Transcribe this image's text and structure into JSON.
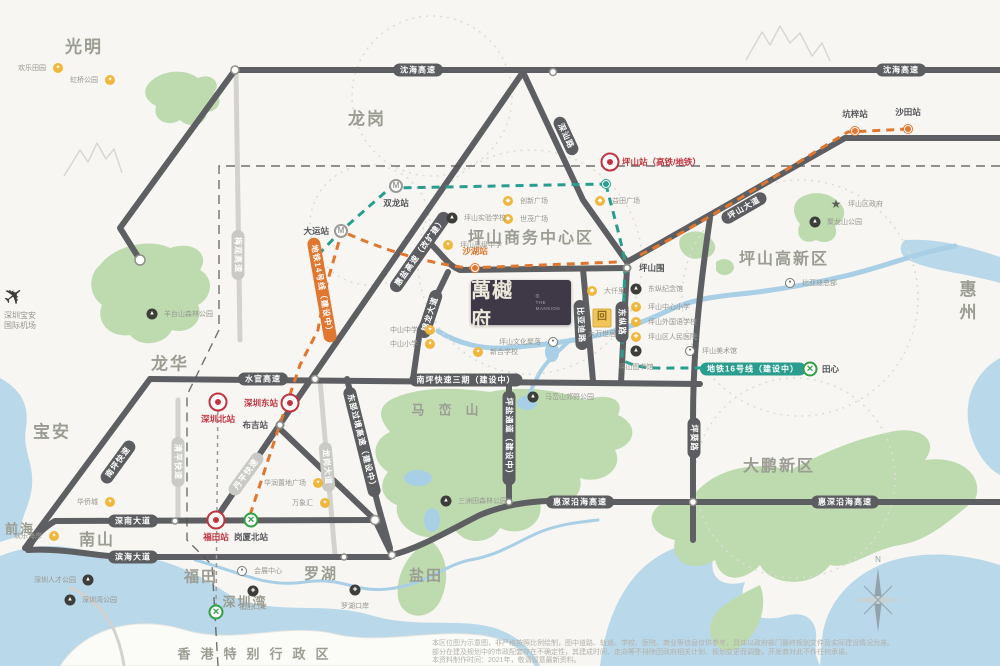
{
  "project": {
    "name": "萬樾府",
    "registered": "®",
    "subtitle_en": "THE MANSION"
  },
  "airport": {
    "line1": "深圳宝安",
    "line2": "国际机场"
  },
  "compass": {
    "north": "N"
  },
  "regions": [
    {
      "text": "光明",
      "x": 84,
      "y": 45,
      "size": 17
    },
    {
      "text": "龙岗",
      "x": 367,
      "y": 117,
      "size": 17
    },
    {
      "text": "龙华",
      "x": 170,
      "y": 362,
      "size": 17
    },
    {
      "text": "宝安",
      "x": 52,
      "y": 430,
      "size": 17
    },
    {
      "text": "南山",
      "x": 97,
      "y": 538,
      "size": 16
    },
    {
      "text": "前海",
      "x": 20,
      "y": 528,
      "size": 13
    },
    {
      "text": "福田",
      "x": 201,
      "y": 576,
      "size": 15
    },
    {
      "text": "罗湖",
      "x": 321,
      "y": 573,
      "size": 15
    },
    {
      "text": "盐田",
      "x": 426,
      "y": 575,
      "size": 15
    },
    {
      "text": "深圳湾",
      "x": 245,
      "y": 601,
      "size": 13
    },
    {
      "text": "惠州",
      "x": 966,
      "y": 303,
      "size": 17,
      "vertical": true
    },
    {
      "text": "大鹏新区",
      "x": 779,
      "y": 464,
      "size": 16
    },
    {
      "text": "坪山商务中心区",
      "x": 531,
      "y": 236,
      "size": 16
    },
    {
      "text": "坪山高新区",
      "x": 784,
      "y": 257,
      "size": 16
    },
    {
      "text": "马峦山",
      "x": 452,
      "y": 409,
      "size": 13,
      "spaced": true
    },
    {
      "text": "香港特别行政区",
      "x": 258,
      "y": 653,
      "size": 13,
      "spaced2": true
    }
  ],
  "pills": [
    {
      "text": "沈海高速",
      "x": 418,
      "y": 70,
      "rot": 0,
      "style": "dark"
    },
    {
      "text": "沈海高速",
      "x": 901,
      "y": 70,
      "rot": 0,
      "style": "dark"
    },
    {
      "text": "深汕路",
      "x": 566,
      "y": 136,
      "rot": 65,
      "style": "dark"
    },
    {
      "text": "坪山大道",
      "x": 744,
      "y": 208,
      "rot": -30,
      "style": "dark"
    },
    {
      "text": "惠盐高速（改扩建）",
      "x": 420,
      "y": 252,
      "rot": -55,
      "style": "dark"
    },
    {
      "text": "水官高速",
      "x": 263,
      "y": 379,
      "rot": 0,
      "style": "dark"
    },
    {
      "text": "南坪快速三期（建设中）",
      "x": 466,
      "y": 380,
      "rot": 0,
      "style": "dark"
    },
    {
      "text": "南坪快速",
      "x": 118,
      "y": 462,
      "rot": -54,
      "style": "dark"
    },
    {
      "text": "东部过境高速（建设中）",
      "x": 362,
      "y": 442,
      "rot": 76,
      "style": "dark"
    },
    {
      "text": "坪盐通道（建设中）",
      "x": 509,
      "y": 438,
      "rot": 90,
      "style": "dark"
    },
    {
      "text": "锦龙大道",
      "x": 430,
      "y": 314,
      "rot": -72,
      "style": "dark"
    },
    {
      "text": "比亚迪路",
      "x": 581,
      "y": 325,
      "rot": 87,
      "style": "dark"
    },
    {
      "text": "东纵路",
      "x": 622,
      "y": 322,
      "rot": 90,
      "style": "dark"
    },
    {
      "text": "坪葵路",
      "x": 694,
      "y": 438,
      "rot": 90,
      "style": "dark"
    },
    {
      "text": "深南大道",
      "x": 133,
      "y": 521,
      "rot": 0,
      "style": "dark"
    },
    {
      "text": "滨海大道",
      "x": 133,
      "y": 557,
      "rot": 0,
      "style": "dark"
    },
    {
      "text": "惠深沿海高速",
      "x": 580,
      "y": 502,
      "rot": 0,
      "style": "dark"
    },
    {
      "text": "惠深沿海高速",
      "x": 845,
      "y": 502,
      "rot": 0,
      "style": "dark"
    },
    {
      "text": "梅观高速",
      "x": 238,
      "y": 255,
      "rot": 90,
      "style": "light"
    },
    {
      "text": "清平快速",
      "x": 178,
      "y": 462,
      "rot": 90,
      "style": "light"
    },
    {
      "text": "丹平快速",
      "x": 246,
      "y": 474,
      "rot": -54,
      "style": "light"
    },
    {
      "text": "龙岗大道",
      "x": 327,
      "y": 467,
      "rot": 85,
      "style": "light"
    },
    {
      "text": "地铁14号线（建设中）",
      "x": 322,
      "y": 290,
      "rot": 80,
      "style": "orange"
    },
    {
      "text": "地铁16号线（建设中）",
      "x": 753,
      "y": 369,
      "rot": 0,
      "style": "teal"
    }
  ],
  "stations": [
    {
      "label": "坪山站（高铁/地铁）",
      "x": 610,
      "y": 162,
      "type": "hsr",
      "side": "r",
      "color": "red"
    },
    {
      "label": "深圳北站",
      "x": 218,
      "y": 402,
      "type": "hsr",
      "side": "b",
      "color": "red"
    },
    {
      "label": "深圳东站",
      "x": 290,
      "y": 403,
      "type": "hsr",
      "side": "l",
      "color": "red"
    },
    {
      "label": "福田站",
      "x": 216,
      "y": 520,
      "type": "hsr",
      "side": "b",
      "color": "red"
    },
    {
      "label": "双龙站",
      "x": 396,
      "y": 186,
      "type": "mgray",
      "side": "b"
    },
    {
      "label": "大运站",
      "x": 341,
      "y": 231,
      "type": "mgray",
      "side": "l"
    },
    {
      "label": "布吉站",
      "x": 280,
      "y": 425,
      "type": "dotc",
      "side": "l"
    },
    {
      "label": "坪山围",
      "x": 627,
      "y": 268,
      "type": "dotc",
      "side": "r"
    },
    {
      "label": "沙湖站",
      "x": 475,
      "y": 268,
      "type": "dotor",
      "side": "t",
      "color": "or"
    },
    {
      "label": "坑梓站",
      "x": 855,
      "y": 131,
      "type": "dotor",
      "side": "t"
    },
    {
      "label": "沙田站",
      "x": 908,
      "y": 129,
      "type": "dotor",
      "side": "t"
    },
    {
      "label": "",
      "x": 606,
      "y": 184,
      "type": "dottl",
      "side": "r"
    },
    {
      "label": "岗厦北站",
      "x": 251,
      "y": 520,
      "type": "mgreen",
      "side": "b"
    },
    {
      "label": "田心",
      "x": 810,
      "y": 369,
      "type": "mgreen",
      "side": "r"
    },
    {
      "label": "",
      "x": 216,
      "y": 612,
      "type": "mgreen",
      "side": "r"
    }
  ],
  "metro_glyph": {
    "gray": "M",
    "green": "✕"
  },
  "amenities": [
    {
      "name": "创新广场",
      "x": 508,
      "y": 201,
      "icon": "mall",
      "side": "r"
    },
    {
      "name": "世茂广场",
      "x": 508,
      "y": 219,
      "icon": "mall",
      "side": "r"
    },
    {
      "name": "益田广场",
      "x": 600,
      "y": 201,
      "icon": "mall",
      "side": "r"
    },
    {
      "name": "坪山实验学校",
      "x": 452,
      "y": 218,
      "icon": "park",
      "side": "r"
    },
    {
      "name": "坪山高级中学",
      "x": 448,
      "y": 245,
      "icon": "school",
      "side": "r"
    },
    {
      "name": "中山中学",
      "x": 430,
      "y": 330,
      "icon": "school",
      "side": "l"
    },
    {
      "name": "中山小学",
      "x": 430,
      "y": 344,
      "icon": "school",
      "side": "l"
    },
    {
      "name": "新合学校",
      "x": 478,
      "y": 352,
      "icon": "school",
      "side": "r"
    },
    {
      "name": "坪山文化聚落",
      "x": 553,
      "y": 342,
      "icon": "museum",
      "side": "l"
    },
    {
      "name": "大仟里",
      "x": 592,
      "y": 291,
      "icon": "mall",
      "side": "r"
    },
    {
      "name": "大万世居",
      "x": 602,
      "y": 318,
      "icon": "heritage",
      "side": "b"
    },
    {
      "name": "东纵纪念馆",
      "x": 636,
      "y": 289,
      "icon": "park",
      "side": "r"
    },
    {
      "name": "坪山中心小学",
      "x": 636,
      "y": 307,
      "icon": "school",
      "side": "r"
    },
    {
      "name": "坪山外国语学校",
      "x": 636,
      "y": 322,
      "icon": "school",
      "side": "r"
    },
    {
      "name": "坪山区人民医院",
      "x": 636,
      "y": 337,
      "icon": "hospital",
      "side": "r"
    },
    {
      "name": "坪山图书馆",
      "x": 636,
      "y": 351,
      "icon": "park",
      "side": "b"
    },
    {
      "name": "坪山美术馆",
      "x": 690,
      "y": 351,
      "icon": "museum",
      "side": "r"
    },
    {
      "name": "聚龙山公园",
      "x": 815,
      "y": 222,
      "icon": "park",
      "side": "r"
    },
    {
      "name": "坪山区政府",
      "x": 836,
      "y": 204,
      "icon": "gov",
      "side": "r"
    },
    {
      "name": "比亚迪总部",
      "x": 790,
      "y": 283,
      "icon": "museum",
      "side": "r"
    },
    {
      "name": "马峦山郊野公园",
      "x": 533,
      "y": 397,
      "icon": "park",
      "side": "r"
    },
    {
      "name": "三洲田森林公园",
      "x": 446,
      "y": 501,
      "icon": "park",
      "side": "r"
    },
    {
      "name": "羊台山森林公园",
      "x": 152,
      "y": 314,
      "icon": "park",
      "side": "r"
    },
    {
      "name": "华侨城",
      "x": 110,
      "y": 502,
      "icon": "school",
      "side": "l"
    },
    {
      "name": "欢乐海岸",
      "x": 54,
      "y": 536,
      "icon": "school",
      "side": "l"
    },
    {
      "name": "华润置地广场",
      "x": 318,
      "y": 483,
      "icon": "school",
      "side": "l"
    },
    {
      "name": "万象汇",
      "x": 325,
      "y": 503,
      "icon": "school",
      "side": "l"
    },
    {
      "name": "深圳人才公园",
      "x": 88,
      "y": 580,
      "icon": "park",
      "side": "l"
    },
    {
      "name": "深圳湾公园",
      "x": 70,
      "y": 600,
      "icon": "park",
      "side": "r"
    },
    {
      "name": "会展中心",
      "x": 242,
      "y": 571,
      "icon": "museum",
      "side": "r"
    },
    {
      "name": "福田口岸",
      "x": 253,
      "y": 591,
      "icon": "port",
      "side": "b"
    },
    {
      "name": "罗湖口岸",
      "x": 355,
      "y": 590,
      "icon": "port",
      "side": "b"
    },
    {
      "name": "欢乐田园",
      "x": 58,
      "y": 68,
      "icon": "school",
      "side": "l"
    },
    {
      "name": "虹桥公园",
      "x": 110,
      "y": 80,
      "icon": "school",
      "side": "l"
    }
  ],
  "disclaimer": [
    "本区位图为示意图，非严格按照比例绘制，图中道路、轨道、学校、医院、商业等信息仅供参考，具体以政府部门最终规划文件及实际建设情况为准。",
    "部分在建及规划中的市政配套存在不确定性，其建成时间、走向等不排除因政府相关计划、规划变更而调整，开发商对此不作任何承诺。",
    "本资料制作时间：2021年，敬请留意最新资料。"
  ]
}
